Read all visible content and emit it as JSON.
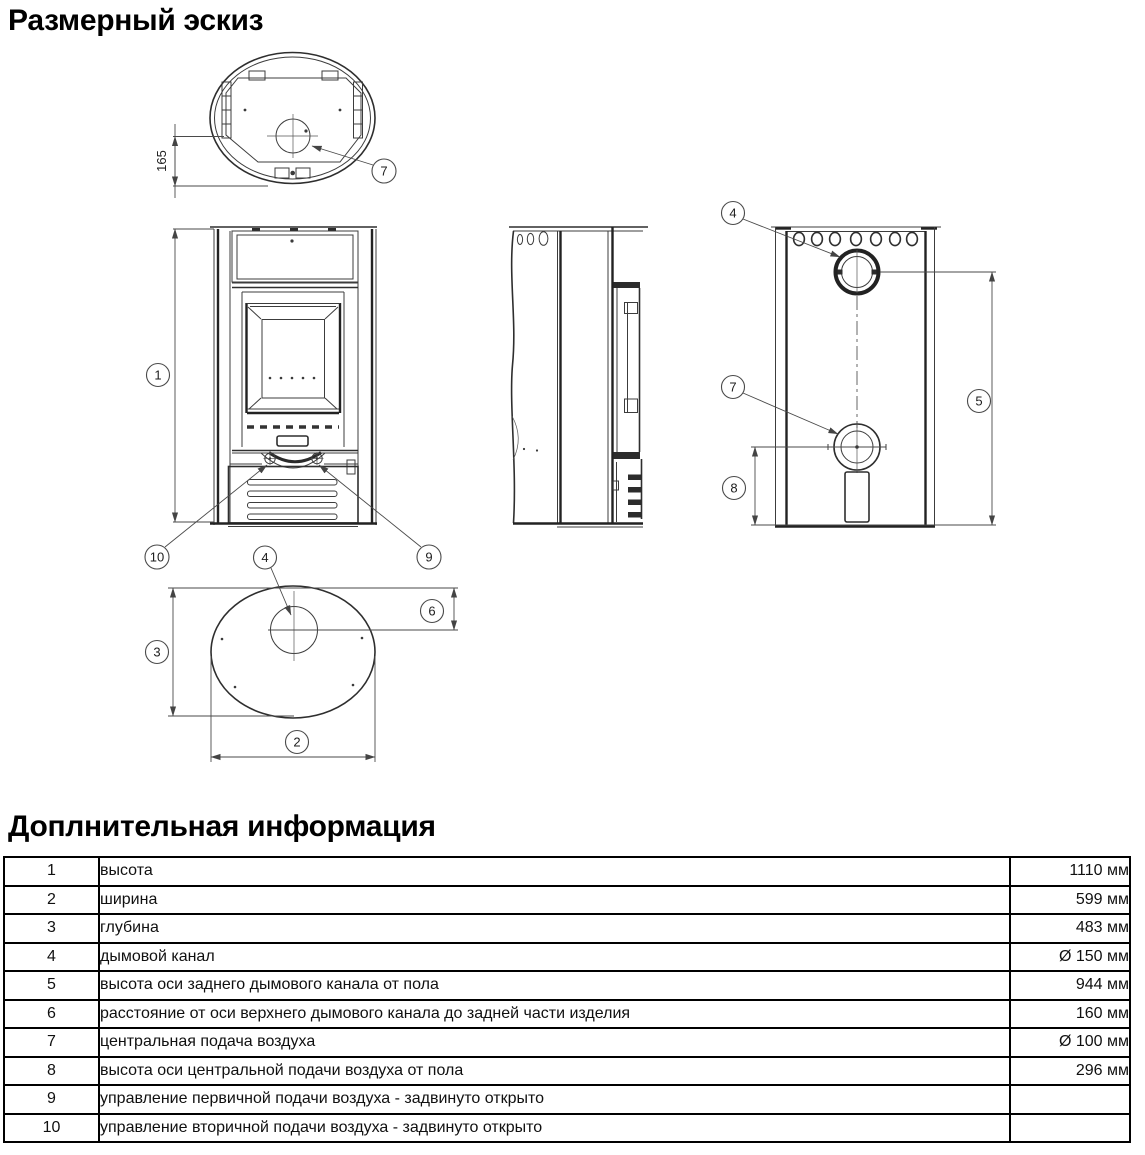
{
  "titles": {
    "sketch": "Размерный эскиз",
    "info": "Доплнительная информация"
  },
  "sketch": {
    "dim_label": "165",
    "callouts": {
      "c1": "1",
      "c2": "2",
      "c3": "3",
      "c4": "4",
      "c5": "5",
      "c6": "6",
      "c7": "7",
      "c8": "8",
      "c9": "9",
      "c10": "10"
    }
  },
  "table": {
    "rows": [
      {
        "num": "1",
        "desc": "высота",
        "value": "1110 мм"
      },
      {
        "num": "2",
        "desc": "ширина",
        "value": "599 мм"
      },
      {
        "num": "3",
        "desc": "глубина",
        "value": "483 мм"
      },
      {
        "num": "4",
        "desc": "дымовой канал",
        "value": "Ø 150 мм"
      },
      {
        "num": "5",
        "desc": "высота оси заднего дымового канала от пола",
        "value": "944 мм"
      },
      {
        "num": "6",
        "desc": "расстояние от оси верхнего дымового канала до задней части изделия",
        "value": "160 мм"
      },
      {
        "num": "7",
        "desc": "центральная подача воздуха",
        "value": "Ø 100 мм"
      },
      {
        "num": "8",
        "desc": "высота оси центральной подачи воздуха от пола",
        "value": "296 мм"
      },
      {
        "num": "9",
        "desc": "управление первичной подачи воздуха - задвинуто открыто",
        "value": ""
      },
      {
        "num": "10",
        "desc": "управление вторичной подачи воздуха - задвинуто открыто",
        "value": ""
      }
    ]
  }
}
